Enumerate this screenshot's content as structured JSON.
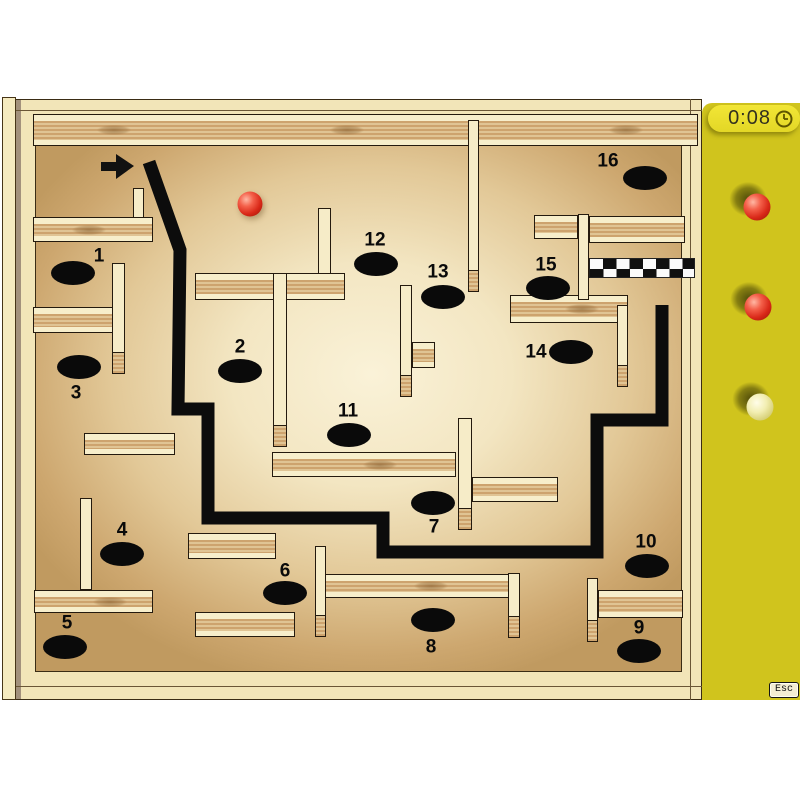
{
  "sidebar": {
    "timer_value": "0:08",
    "timer_icon": "clock",
    "esc_label": "Esc",
    "color": "#d0c41d",
    "lives": [
      {
        "type": "red",
        "x": 757,
        "y": 207
      },
      {
        "type": "red",
        "x": 758,
        "y": 307
      },
      {
        "type": "pale",
        "x": 760,
        "y": 407
      }
    ]
  },
  "board": {
    "frame_color": "#f2e5b8",
    "floor_center_color": "#faf2d8",
    "floor_edge_color": "#c09a60",
    "plank_color": "#f6ecc8",
    "path_color": "#0c0c0c"
  },
  "maze": {
    "marble": {
      "x": 250,
      "y": 204,
      "color": "#d92818"
    },
    "arrow": {
      "points": "101,162 116,162 116,154 134,166 116,179 116,171 101,171",
      "color": "#111111"
    },
    "path": {
      "points": "149,162 180,250 178,409 208,409 208,518 383,518 383,552 597,552 597,420 662,420 662,305",
      "width": 13,
      "color": "#0c0c0c"
    },
    "finish": {
      "x": 589,
      "y": 258,
      "w": 106,
      "h": 20,
      "cols": 8,
      "dark": "#101010",
      "light": "#fafafa"
    },
    "holes": [
      {
        "n": "1",
        "hx": 73,
        "hy": 273,
        "lx": 99,
        "ly": 256
      },
      {
        "n": "2",
        "hx": 240,
        "hy": 371,
        "lx": 240,
        "ly": 347
      },
      {
        "n": "3",
        "hx": 79,
        "hy": 367,
        "lx": 76,
        "ly": 393
      },
      {
        "n": "4",
        "hx": 122,
        "hy": 554,
        "lx": 122,
        "ly": 530
      },
      {
        "n": "5",
        "hx": 65,
        "hy": 647,
        "lx": 67,
        "ly": 623
      },
      {
        "n": "6",
        "hx": 285,
        "hy": 593,
        "lx": 285,
        "ly": 571
      },
      {
        "n": "7",
        "hx": 433,
        "hy": 503,
        "lx": 434,
        "ly": 527
      },
      {
        "n": "8",
        "hx": 433,
        "hy": 620,
        "lx": 431,
        "ly": 647
      },
      {
        "n": "9",
        "hx": 639,
        "hy": 651,
        "lx": 639,
        "ly": 628
      },
      {
        "n": "10",
        "hx": 647,
        "hy": 566,
        "lx": 646,
        "ly": 542
      },
      {
        "n": "11",
        "hx": 349,
        "hy": 435,
        "lx": 348,
        "ly": 411
      },
      {
        "n": "12",
        "hx": 376,
        "hy": 264,
        "lx": 375,
        "ly": 240
      },
      {
        "n": "13",
        "hx": 443,
        "hy": 297,
        "lx": 438,
        "ly": 272
      },
      {
        "n": "14",
        "hx": 571,
        "hy": 352,
        "lx": 536,
        "ly": 352
      },
      {
        "n": "15",
        "hx": 548,
        "hy": 288,
        "lx": 546,
        "ly": 265
      },
      {
        "n": "16",
        "hx": 645,
        "hy": 178,
        "lx": 608,
        "ly": 161
      }
    ],
    "walls": [
      {
        "x": 33,
        "y": 114,
        "w": 665,
        "h": 32,
        "dir": "h",
        "knots": [
          0.12,
          0.47,
          0.89
        ]
      },
      {
        "x": 33,
        "y": 217,
        "w": 120,
        "h": 25,
        "dir": "h",
        "knots": [
          0.46
        ]
      },
      {
        "x": 33,
        "y": 307,
        "w": 80,
        "h": 26,
        "dir": "h"
      },
      {
        "x": 195,
        "y": 273,
        "w": 150,
        "h": 27,
        "dir": "h"
      },
      {
        "x": 84,
        "y": 433,
        "w": 91,
        "h": 22,
        "dir": "h"
      },
      {
        "x": 272,
        "y": 452,
        "w": 184,
        "h": 25,
        "dir": "h",
        "knots": [
          0.58
        ]
      },
      {
        "x": 472,
        "y": 477,
        "w": 86,
        "h": 25,
        "dir": "h"
      },
      {
        "x": 188,
        "y": 533,
        "w": 88,
        "h": 26,
        "dir": "h"
      },
      {
        "x": 34,
        "y": 590,
        "w": 119,
        "h": 23,
        "dir": "h",
        "knots": [
          0.63
        ]
      },
      {
        "x": 195,
        "y": 612,
        "w": 100,
        "h": 25,
        "dir": "h"
      },
      {
        "x": 325,
        "y": 574,
        "w": 195,
        "h": 24,
        "dir": "h",
        "knots": [
          0.54
        ]
      },
      {
        "x": 598,
        "y": 590,
        "w": 85,
        "h": 28,
        "dir": "h"
      },
      {
        "x": 534,
        "y": 215,
        "w": 44,
        "h": 24,
        "dir": "h"
      },
      {
        "x": 589,
        "y": 216,
        "w": 96,
        "h": 27,
        "dir": "h"
      },
      {
        "x": 510,
        "y": 295,
        "w": 118,
        "h": 28,
        "dir": "h",
        "knots": [
          0.6
        ]
      },
      {
        "x": 412,
        "y": 342,
        "w": 23,
        "h": 26,
        "dir": "h"
      },
      {
        "x": 133,
        "y": 188,
        "w": 11,
        "h": 30,
        "dir": "v"
      },
      {
        "x": 112,
        "y": 263,
        "w": 13,
        "h": 111,
        "dir": "v",
        "tip": true
      },
      {
        "x": 318,
        "y": 208,
        "w": 13,
        "h": 66,
        "dir": "v"
      },
      {
        "x": 273,
        "y": 273,
        "w": 14,
        "h": 174,
        "dir": "v",
        "tip": true
      },
      {
        "x": 468,
        "y": 120,
        "w": 11,
        "h": 172,
        "dir": "v",
        "tip": true
      },
      {
        "x": 400,
        "y": 285,
        "w": 12,
        "h": 112,
        "dir": "v",
        "tip": true
      },
      {
        "x": 80,
        "y": 498,
        "w": 12,
        "h": 92,
        "dir": "v"
      },
      {
        "x": 458,
        "y": 418,
        "w": 14,
        "h": 112,
        "dir": "v",
        "tip": true
      },
      {
        "x": 578,
        "y": 214,
        "w": 11,
        "h": 86,
        "dir": "v"
      },
      {
        "x": 617,
        "y": 305,
        "w": 11,
        "h": 82,
        "dir": "v",
        "tip": true
      },
      {
        "x": 587,
        "y": 578,
        "w": 11,
        "h": 64,
        "dir": "v",
        "tip": true
      },
      {
        "x": 315,
        "y": 546,
        "w": 11,
        "h": 91,
        "dir": "v",
        "tip": true
      },
      {
        "x": 508,
        "y": 573,
        "w": 12,
        "h": 65,
        "dir": "v",
        "tip": true
      }
    ]
  }
}
